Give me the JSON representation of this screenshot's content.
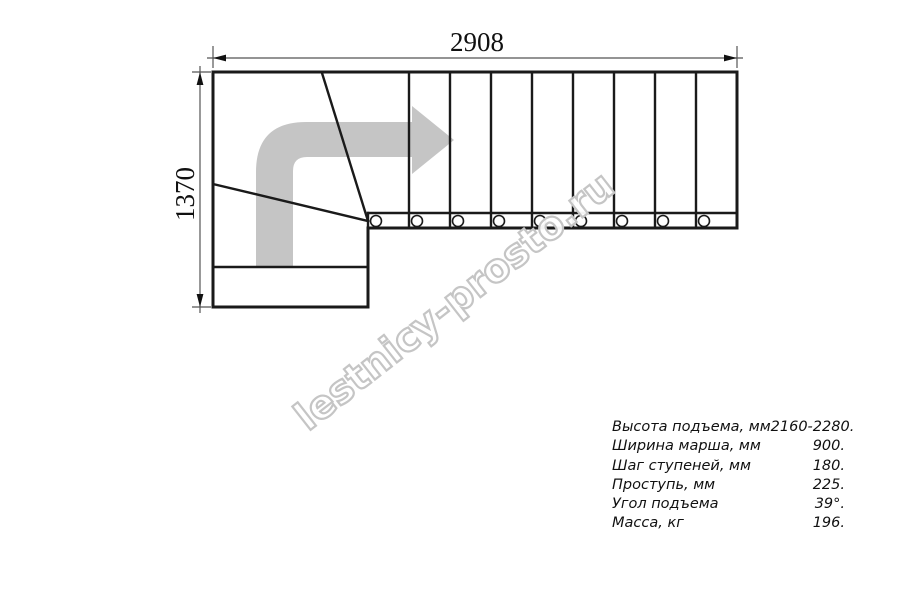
{
  "dimensions": {
    "width_mm": "2908",
    "height_mm": "1370"
  },
  "watermark": {
    "text": "lestnicy-prosto.ru"
  },
  "specs": {
    "rows": [
      {
        "label": "Высота подъема, мм",
        "value": "2160-2280."
      },
      {
        "label": "Ширина марша, мм",
        "value": "900."
      },
      {
        "label": "Шаг ступеней, мм",
        "value": "180."
      },
      {
        "label": "Проступь, мм",
        "value": "225."
      },
      {
        "label": "Угол подъема",
        "value": "39°."
      },
      {
        "label": "Масса, кг",
        "value": "196."
      }
    ]
  },
  "colors": {
    "line": "#1a1a1a",
    "arrow_fill": "#c5c5c5",
    "watermark_outline": "#c5c5c5",
    "dimension_line": "#555555"
  }
}
